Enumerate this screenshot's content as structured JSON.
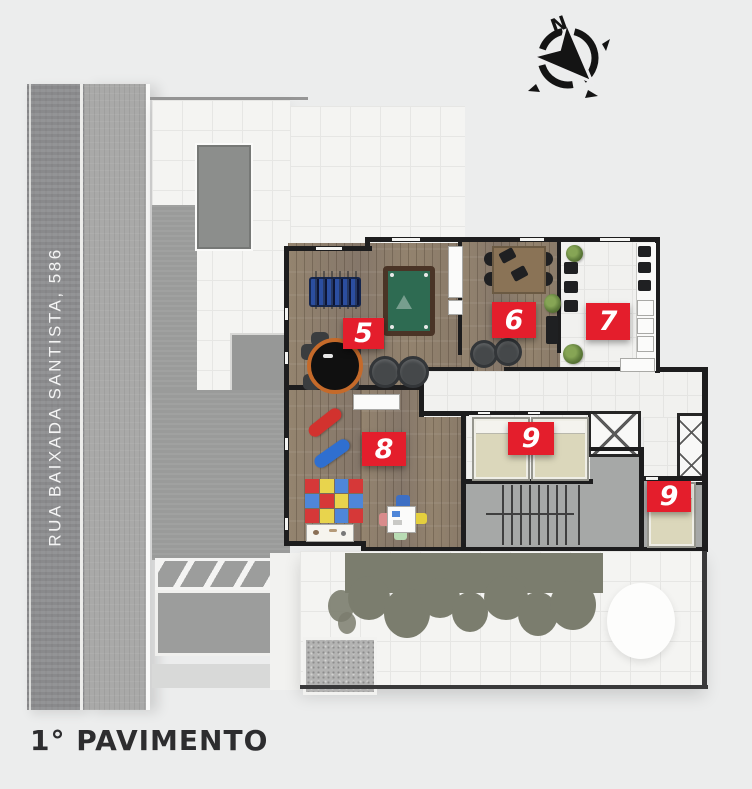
{
  "title": "1° PAVIMENTO",
  "street": {
    "label": "RUA BAIXADA SANTISTA, 586"
  },
  "compass": {
    "north_label": "N"
  },
  "floor_plan": {
    "badges": [
      {
        "id": "room-5",
        "number": "5"
      },
      {
        "id": "room-6",
        "number": "6"
      },
      {
        "id": "room-7",
        "number": "7"
      },
      {
        "id": "room-8",
        "number": "8"
      },
      {
        "id": "room-9-left",
        "number": "9"
      },
      {
        "id": "room-9-right",
        "number": "9"
      }
    ]
  },
  "colors": {
    "badge": "#e41e2c",
    "wall": "#1d1d1e",
    "background": "#eceded",
    "wood_floor": "#8f8170",
    "street": "#8f9092",
    "hedge": "#7b7d6e"
  }
}
